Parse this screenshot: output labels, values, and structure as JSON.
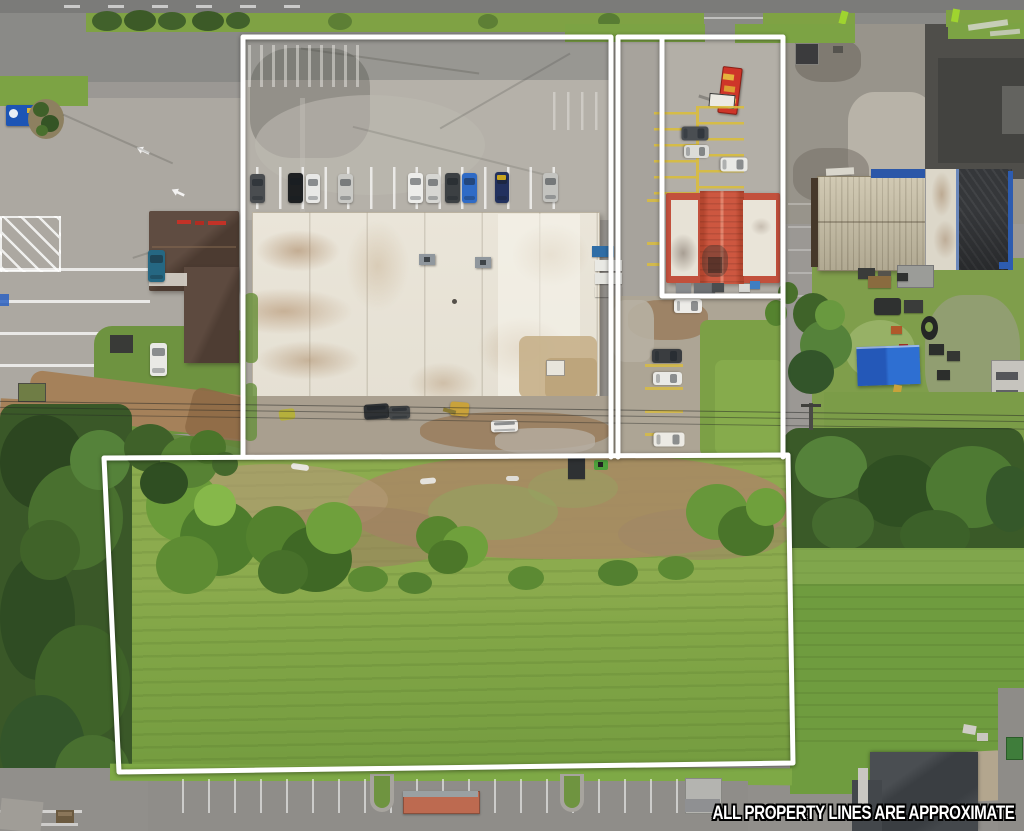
{
  "image": {
    "width": 1024,
    "height": 831,
    "kind": "aerial-drone-property-photo"
  },
  "caption": {
    "text": "ALL PROPERTY LINES ARE APPROXIMATE"
  },
  "property_lines": {
    "stroke_color": "#ffffff",
    "stroke_width": 5,
    "parcels": [
      {
        "name": "main-lot-outline",
        "closed": false,
        "points": [
          [
            243,
            457
          ],
          [
            243,
            37
          ],
          [
            611,
            37
          ],
          [
            611,
            457
          ]
        ]
      },
      {
        "name": "east-strip-outline",
        "closed": false,
        "points": [
          [
            618,
            457
          ],
          [
            618,
            37
          ],
          [
            783,
            37
          ],
          [
            783,
            457
          ]
        ]
      },
      {
        "name": "restaurant-pad-divider",
        "closed": false,
        "points": [
          [
            662,
            37
          ],
          [
            662,
            296
          ],
          [
            783,
            296
          ]
        ]
      },
      {
        "name": "rear-field-outline",
        "closed": true,
        "points": [
          [
            104,
            458
          ],
          [
            788,
            455
          ],
          [
            793,
            763
          ],
          [
            119,
            772
          ]
        ]
      }
    ]
  },
  "colors": {
    "caption_text": "#ffffff",
    "caption_outline": "#000000",
    "property_line": "#ffffff",
    "road": "#84847f",
    "asphalt": "#9b9894",
    "concrete_lot": "#b5b1a9",
    "white_roof": "#eae5d9",
    "roof_stain": "#a9845f",
    "red_roof": "#c6503b",
    "brown_roof": "#55433a",
    "tan_metal_roof": "#c9c0a6",
    "charcoal_roof": "#35373a",
    "blue_trim": "#2b57a8",
    "blue_tarp": "#2e6fd2",
    "field_grass": "#87a94b",
    "lawn_grass": "#6f9c3f",
    "tree_dark": "#2f4d22",
    "tree_light": "#6b9c3a",
    "dirt_road": "#a5815a",
    "yellow_stripe": "#d9bd3e"
  }
}
